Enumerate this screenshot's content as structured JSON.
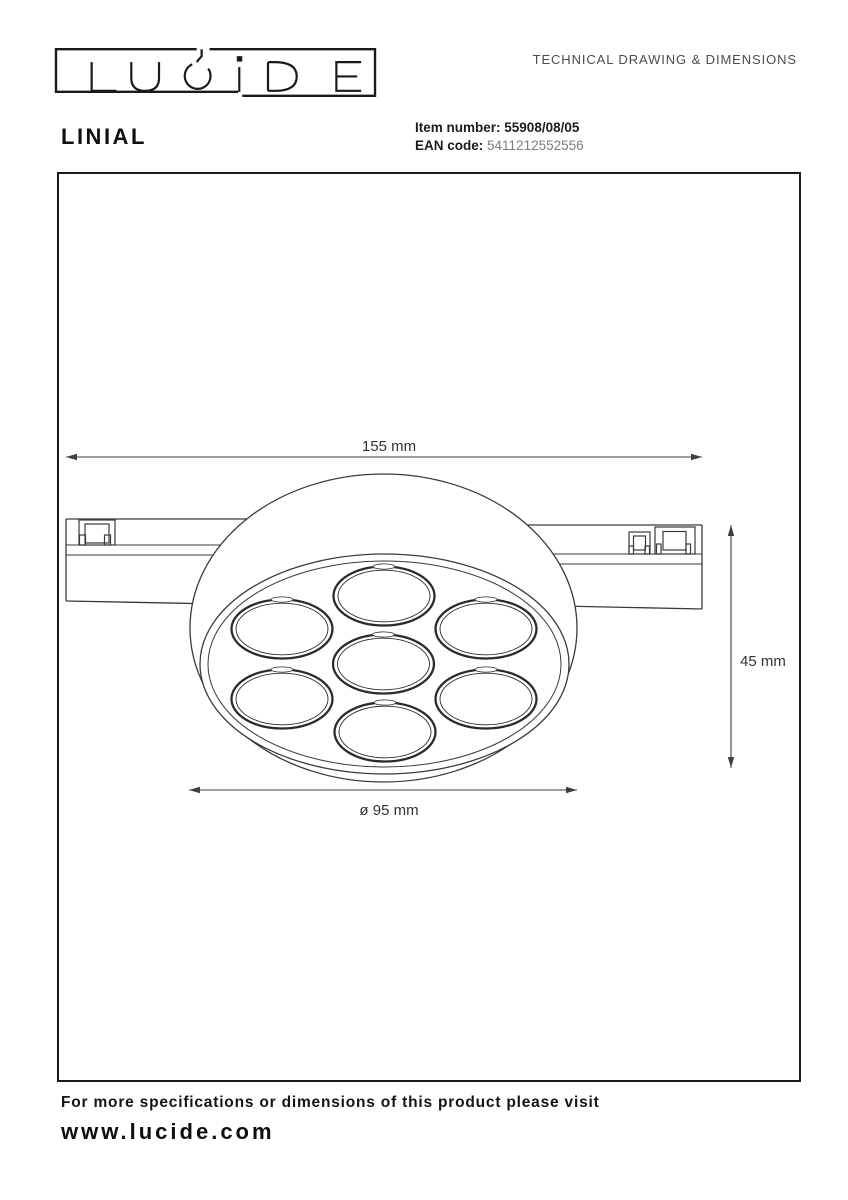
{
  "header": {
    "logo_text": "LUCIDE",
    "doc_title": "TECHNICAL DRAWING & DIMENSIONS"
  },
  "product": {
    "name": "LINIAL",
    "item_number_label": "Item number:",
    "item_number": "55908/08/05",
    "ean_label": "EAN code:",
    "ean": "5411212552556"
  },
  "drawing": {
    "width_dimension": "155 mm",
    "height_dimension": "45 mm",
    "diameter_dimension": "ø 95 mm"
  },
  "footer": {
    "note": "For more specifications or dimensions of this product please visit",
    "website": "www.lucide.com"
  },
  "colors": {
    "line": "#3a3a3a",
    "text": "#1a1a1a",
    "muted": "#7d7d7d"
  }
}
